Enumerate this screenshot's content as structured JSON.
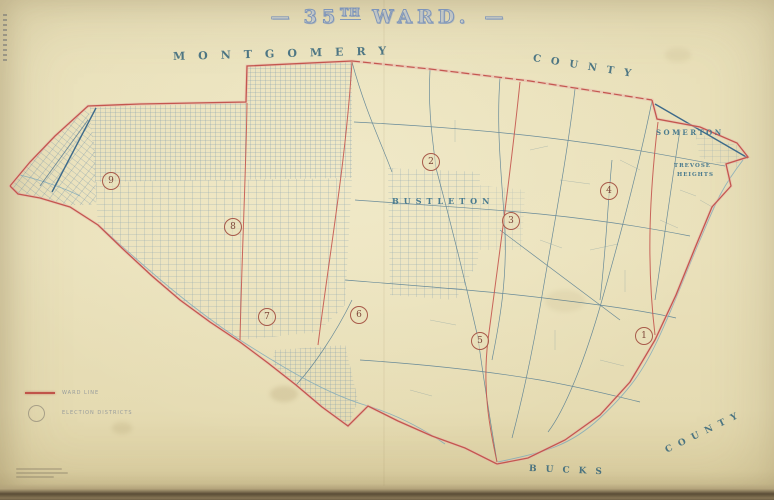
{
  "title": {
    "dash_left": "—",
    "number": "35",
    "ordinal": "TH",
    "word": " WARD.",
    "dash_right": "—"
  },
  "county_labels": {
    "top_left": "MONTGOMERY",
    "top_right": "COUNTY",
    "bottom_left": "BUCKS",
    "bottom_right": "COUNTY"
  },
  "place_labels": {
    "bustleton": "BUSTLETON",
    "somerton": "SOMERTON",
    "trevose_line1": "TREVOSE",
    "trevose_line2": "HEIGHTS"
  },
  "districts": [
    {
      "number": "1"
    },
    {
      "number": "2"
    },
    {
      "number": "3"
    },
    {
      "number": "4"
    },
    {
      "number": "5"
    },
    {
      "number": "6"
    },
    {
      "number": "7"
    },
    {
      "number": "8"
    },
    {
      "number": "9"
    }
  ],
  "legend": {
    "ward_line_label": "WARD LINE",
    "districts_label": "ELECTION DISTRICTS"
  },
  "colors": {
    "paper": "#e9e0ba",
    "map_blue": "#49758f",
    "creek_blue": "#7aa7ba",
    "boundary_red": "#c4564f",
    "boundary_pink": "#e8b5ac",
    "label_teal": "#33647a",
    "title_blue": "#7e95ba"
  }
}
